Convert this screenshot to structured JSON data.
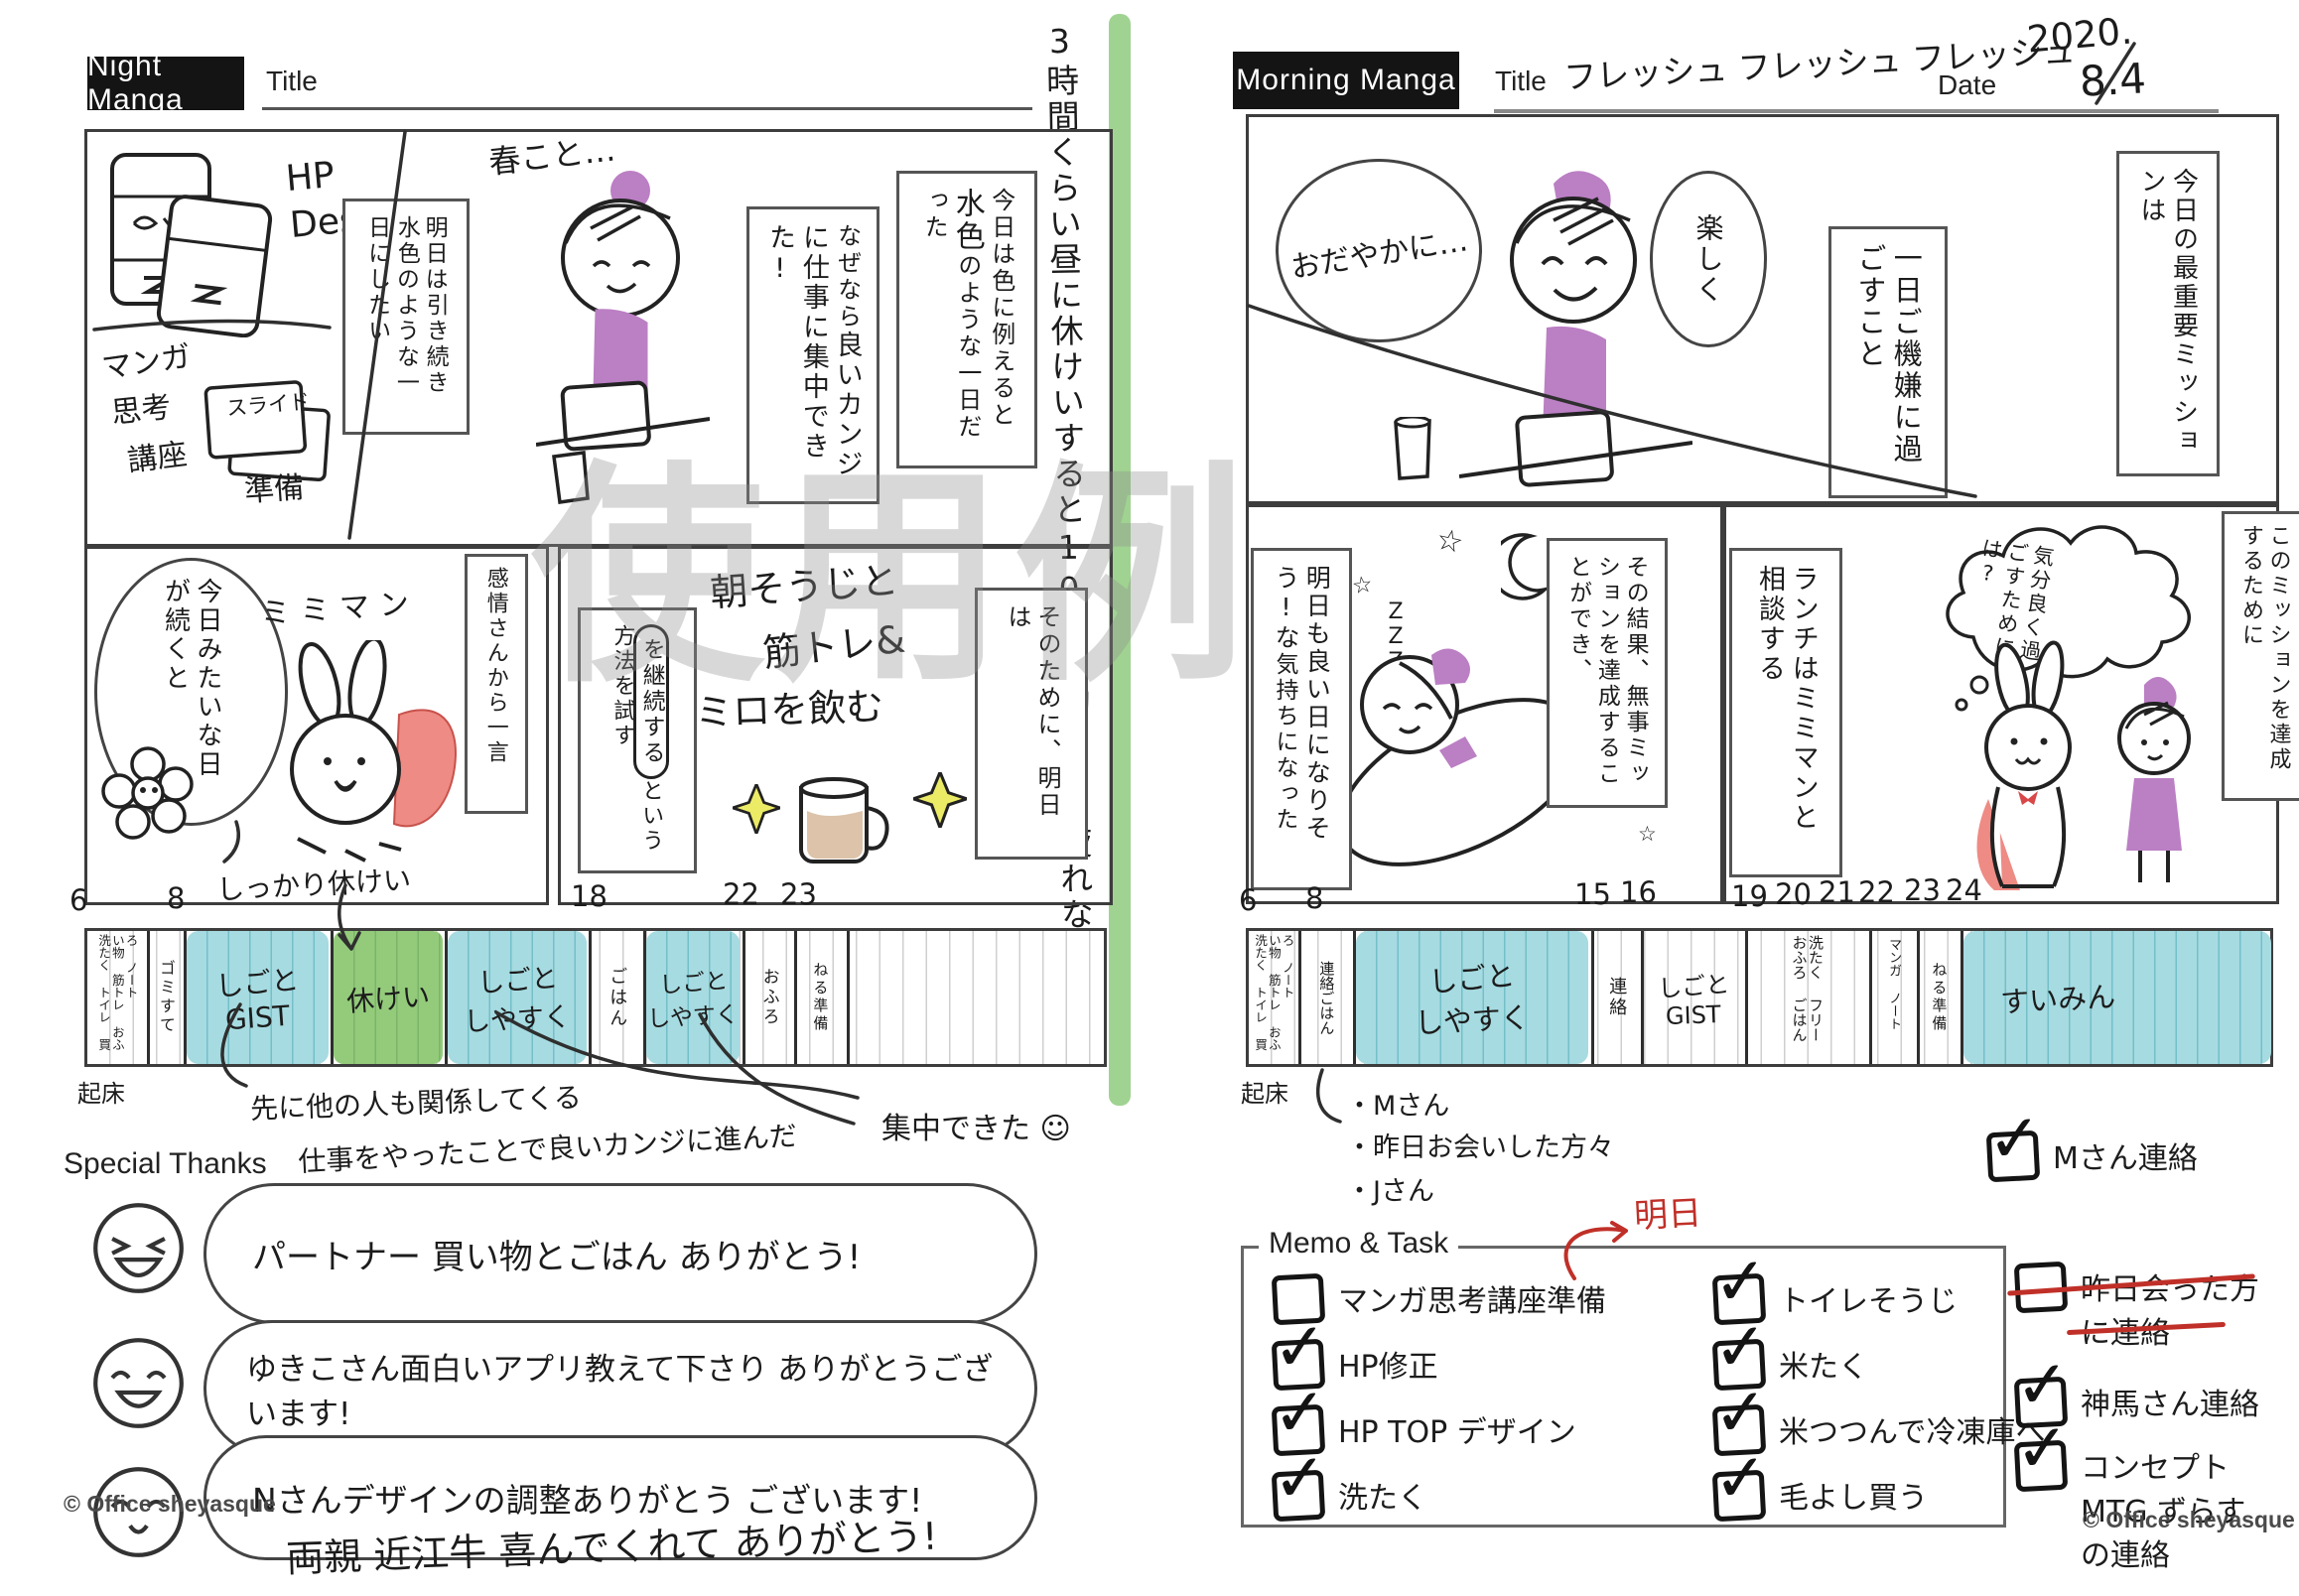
{
  "watermark": "使用例",
  "center_note": "3時間くらい昼に休けいすると10時間働いても疲れない",
  "colors": {
    "highlight_green": "#8fcb7e",
    "timeline_blue": "#a6dbe1",
    "timeline_green": "#93cb7b",
    "accent_purple": "#bb7fc4",
    "cape_red": "#ee8b84",
    "pen_red": "#c03028",
    "sparkle_yellow": "#eceb66"
  },
  "night": {
    "badge": "Night Manga",
    "title_label": "Title",
    "copyright": "© Office sheyasque",
    "panel1": {
      "hp_design": "HP Design",
      "manga_course_line1": "マンガ",
      "manga_course_line2": "思考",
      "manga_course_line3": "講座",
      "junbi": "準備",
      "slide_label": "スライド",
      "tomorrow_printed1": "明日は",
      "tomorrow_hand1": "引き続き",
      "tomorrow_hand2": "水色",
      "tomorrow_printed2": "のような一日にしたい",
      "haru_note": "春こと…",
      "today_printed1": "今日は色に例えると",
      "today_hand": "水色",
      "today_printed2": "のような一日だった",
      "reason_printed": "なぜなら",
      "reason_hand": "良いカンジに仕事に集中できた!"
    },
    "panel2": {
      "bubble": "今日みたいな日が続くと",
      "character_name": "ミミマン",
      "emotion_label": "感情さんから一言",
      "continue_hand": "を継続する",
      "method_printed": "という方法を試す",
      "morning_plan_line1": "朝そうじと",
      "morning_plan_line2": "筋トレ&",
      "morning_plan_line3": "ミロを飲む",
      "for_that_printed": "そのために、明日は"
    },
    "timeline": {
      "hours": [
        "6",
        "8",
        "18",
        "22",
        "23"
      ],
      "rest_note": "しっかり休けい",
      "wake_label": "起床",
      "segments": {
        "morning_list": "洗たく トイレ 買い物 筋トレ おふろ ノート",
        "gomi": "ゴミすて",
        "work1_line1": "しごと",
        "work1_line2": "GIST",
        "rest": "休けい",
        "work2_line1": "しごと",
        "work2_line2": "しやすく",
        "dinner": "ごはん",
        "work3_line1": "しごと",
        "work3_line2": "しやすく",
        "bath": "おふろ",
        "sleep_prep": "ねる準備"
      },
      "note1_line1": "先に他の人も関係してくる",
      "note1_line2": "仕事をやったことで良いカンジに進んだ",
      "note2": "集中できた ☺"
    },
    "thanks": {
      "label": "Special Thanks",
      "bubble1": "パートナー 買い物とごはん ありがとう!",
      "bubble2": "ゆきこさん面白いアプリ教えて下さり ありがとうございます!",
      "bubble3": "Nさんデザインの調整ありがとう ございます!",
      "extra": "両親 近江牛 喜んでくれて ありがとう!"
    }
  },
  "morning": {
    "badge": "Morning Manga",
    "title_label": "Title",
    "title_value": "フレッシュ フレッシュ フレッシュ",
    "date_label": "Date",
    "date_year": "2020.",
    "date_day": "8.4",
    "copyright": "© Office sheyasque",
    "panel1": {
      "bubble1": "おだやかに…",
      "bubble2": "楽しく",
      "mission_hand": "一日ご機嫌に過ごすこと",
      "mission_label": "今日の最重要ミッションは"
    },
    "panel2": {
      "for_mission_label": "このミッションを達成するために",
      "cloud": "気分良く過ごすためには?",
      "zzz": "ZZZ",
      "result_label": "その結果、無事ミッションを達成することができ、",
      "feeling_hand": "明日も良い日になりそう!な",
      "feeling_printed": "気持ちになった",
      "lunch_hand": "ランチはミミマンと相談する"
    },
    "timeline": {
      "hours": [
        "6",
        "8",
        "15",
        "16",
        "19",
        "20",
        "21",
        "22",
        "23",
        "24"
      ],
      "wake_label": "起床",
      "segments": {
        "morning_list": "洗たく トイレ 買い物 筋トレ おふろ ノート",
        "renraku_gohan": "連絡ごはん",
        "work1_line1": "しごと",
        "work1_line2": "しやすく",
        "renraku": "連絡",
        "work2_line1": "しごと",
        "work2_line2": "GIST",
        "evening_list": "おふろ ごはん 洗たく フリー",
        "manga_note": "マンガ ノート",
        "sleep_prep": "ねる準備",
        "sleep": "すいみん"
      },
      "bullet1": "・Mさん",
      "bullet2": "・昨日お会いした方々",
      "bullet3": "・Jさん"
    },
    "m_san_check": "Mさん連絡",
    "memo": {
      "label": "Memo & Task",
      "red_note": "明日",
      "col1": [
        {
          "label": "マンガ思考講座準備",
          "checked": false
        },
        {
          "label": "HP修正",
          "checked": true
        },
        {
          "label": "HP TOP デザイン",
          "checked": true
        },
        {
          "label": "洗たく",
          "checked": true
        }
      ],
      "col2": [
        {
          "label": "トイレそうじ",
          "checked": true
        },
        {
          "label": "米たく",
          "checked": true
        },
        {
          "label": "米つつんで冷凍庫へ",
          "checked": true
        },
        {
          "label": "毛よし買う",
          "checked": true
        }
      ],
      "col3": [
        {
          "label": "昨日会った方に連絡",
          "checked": false,
          "struck": true
        },
        {
          "label": "神馬さん連絡",
          "checked": true
        },
        {
          "label": "コンセプトMTG ずらすの連絡",
          "checked": true
        }
      ]
    }
  }
}
